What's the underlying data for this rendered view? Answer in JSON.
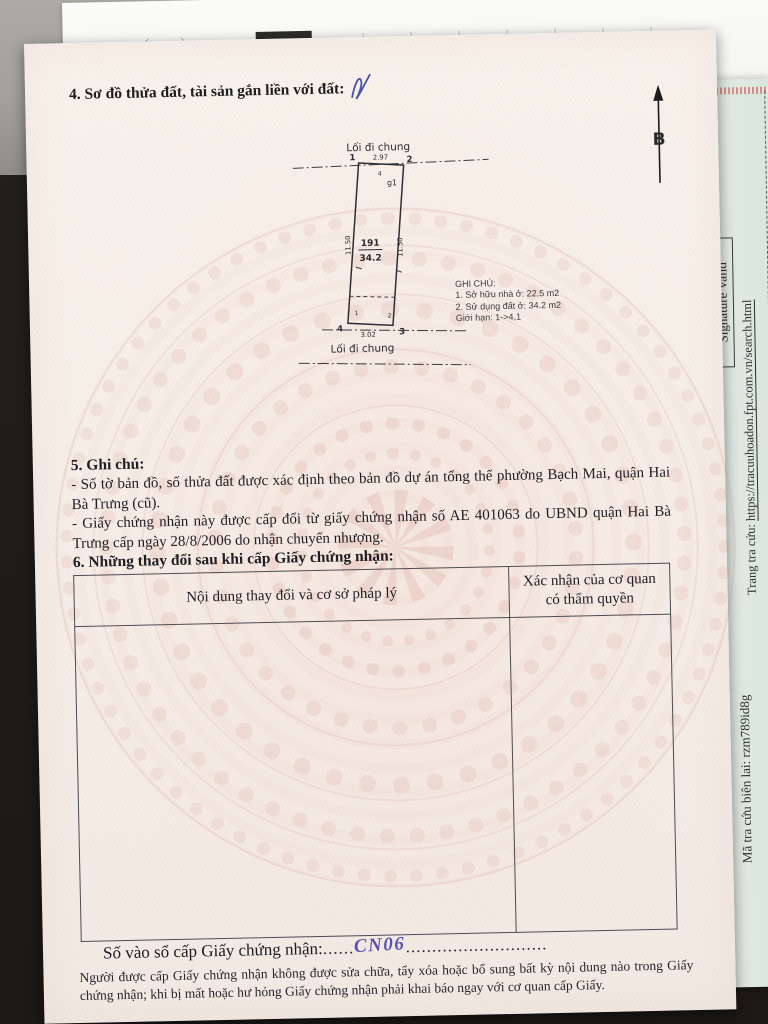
{
  "colors": {
    "certificate_paper": "#f6efe9",
    "pattern_pink": "#d99a8e",
    "side_paper_green": "#dde8e1",
    "handwriting_ink": "#5753ad",
    "background_dark": "#1f1c19"
  },
  "certificate": {
    "section4_title": "4. Sơ đồ thửa đất, tài sản gắn liền với đất:",
    "north_label": "B",
    "diagram": {
      "top_path_label": "Lối đi chung",
      "bottom_path_label": "Lối đi chung",
      "plot_number": "191",
      "plot_area": "34.2",
      "dim_top": "2.97",
      "dim_bottom": "3.02",
      "dim_left": "11.50",
      "dim_right": "11.50",
      "corner_1": "1",
      "corner_2": "2",
      "corner_3": "3",
      "corner_4": "4",
      "g1_label": "g1",
      "mark_top": "4",
      "mark_bottom_left": "1",
      "mark_bottom_right": "2",
      "notes_title": "GHI CHÚ:",
      "notes": [
        "1. Sở hữu nhà ở: 22.5 m2",
        "2. Sử dụng đất ở: 34.2 m2",
        "Giới hạn: 1->4,1"
      ]
    },
    "section5": {
      "title": "5. Ghi chú:",
      "item1": "- Số tờ bản đồ, số thửa đất được xác định theo bản đồ dự án tổng thể phường Bạch Mai, quận Hai Bà Trưng (cũ).",
      "item2": "- Giấy chứng nhận này được cấp đổi từ giấy chứng nhận số AE 401063 do UBND quận Hai Bà Trưng cấp ngày 28/8/2006 do nhận chuyển nhượng."
    },
    "section6": {
      "title": "6. Những thay đổi sau khi cấp Giấy chứng nhận:",
      "col1_header": "Nội dung thay đổi và cơ sở pháp lý",
      "col2_header": "Xác nhận của cơ quan có thẩm quyền"
    },
    "registry": {
      "label": "Số vào sổ cấp Giấy chứng nhận:",
      "dots_left": "......",
      "value": "CN06",
      "dots_right": "..........................."
    },
    "footer": "Người được cấp Giấy chứng nhận không được sửa chữa, tẩy xóa hoặc bổ sung bất kỳ nội dung nào trong Giấy chứng nhận; khi bị mất hoặc hư hỏng Giấy chứng nhận phải khai báo ngay với cơ quan cấp Giấy."
  },
  "side_paper": {
    "signature_valid": "Signature Valid",
    "lookup_label": "Trang tra cứu: ",
    "lookup_url": "https://tracuuhoadon.fpt.com.vn/search.html",
    "lookup_code": "Mã tra cứu biên lai: rzm789id8g",
    "fragment": "n hóa đơn)"
  },
  "background_sheet": {
    "marks": "( )"
  }
}
